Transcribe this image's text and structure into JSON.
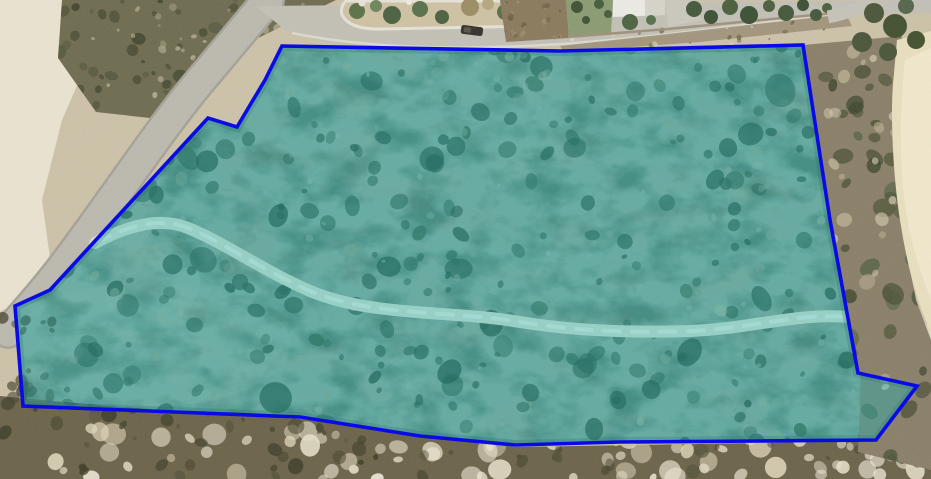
{
  "meta": {
    "view_type": "aerial-satellite-imagery",
    "description": "Satellite photo of coastal scrubland with a surveyed land parcel outlined in blue and washed with a translucent teal highlight; roads and houses border the parcel to the north-west and north."
  },
  "canvas": {
    "width": 931,
    "height": 479,
    "base_color": "#cdc2a8"
  },
  "parcel": {
    "name": "parcel-boundary-overlay",
    "fill": "rgba(0,195,210,0.30)",
    "stroke": "#0a0ae6",
    "stroke_width": 3.6,
    "points": "282,46 560,51 803,45 830,220 858,373 917,386 876,440 760,441 620,442 515,445 420,436 300,417 23,406 15,306 50,290 208,118 237,127 265,80"
  },
  "clips": {
    "parcel": "282,46 560,51 803,45 830,220 858,373 917,386 876,440 760,441 620,442 515,445 420,436 300,417 23,406 15,306 50,290 208,118 237,127 265,80",
    "bottom": "0,396 120,407 300,419 515,447 876,441 931,398 931,479 0,479",
    "right": "803,45 902,36 896,120 902,228 916,300 931,340 931,470 858,452 861,380 828,220",
    "topleft": "62,0 336,0 258,38 205,92 150,118 96,112 58,58"
  },
  "layers": [
    {
      "type": "rect",
      "name": "sand-base",
      "x": 0,
      "y": 0,
      "w": 931,
      "h": 479,
      "fill": "#cdc2a8"
    },
    {
      "type": "polygon",
      "name": "white-sand-west",
      "points": "0,0 72,0 96,42 62,120 42,200 50,258 22,300 0,312",
      "fill": "#ebe5d2",
      "opacity": 0.95
    },
    {
      "type": "ellipse",
      "name": "white-sand-southwest",
      "cx": 60,
      "cy": 448,
      "rx": 130,
      "ry": 38,
      "fill": "#e7e1ce",
      "opacity": 0.9
    },
    {
      "type": "polygon",
      "name": "scrub-northwest",
      "points": "62,0 336,0 258,38 205,92 150,118 96,112 58,58",
      "fill": "#6e6b4f"
    },
    {
      "type": "scatter",
      "name": "scrub-northwest-bushes",
      "clip": "topleft",
      "seed": 11,
      "count": 70,
      "colors": [
        "#45482e",
        "#3c402a",
        "#50543a"
      ],
      "area": [
        58,
        0,
        334,
        120
      ],
      "rmin": 2,
      "rmax": 8,
      "omin": 0.5,
      "omax": 0.85
    },
    {
      "type": "scatter",
      "name": "scrub-northwest-sand-specks",
      "clip": "topleft",
      "seed": 12,
      "count": 40,
      "colors": [
        "#b6b092",
        "#d9d3b8"
      ],
      "area": [
        58,
        0,
        334,
        120
      ],
      "rmin": 1.5,
      "rmax": 5,
      "omin": 0.4,
      "omax": 0.7
    },
    {
      "type": "path",
      "name": "road-west-casing",
      "d": "M 268 0 L 196 86 C 152 140 112 202 62 268 C 42 294 26 312 8 332",
      "stroke": "#a5a296",
      "width": 34,
      "cap": "round"
    },
    {
      "type": "path",
      "name": "road-west",
      "d": "M 268 0 L 196 86 C 152 140 112 202 62 268 C 42 294 26 312 8 332",
      "stroke": "#bcb9af",
      "width": 29,
      "cap": "round"
    },
    {
      "type": "path",
      "name": "road-southwest-edge",
      "d": "M 0 450 L 300 470",
      "stroke": "#8a8779",
      "width": 3
    },
    {
      "type": "path",
      "name": "road-southwest",
      "d": "M 0 462 L 300 478",
      "stroke": "#b2afa6",
      "width": 18
    },
    {
      "type": "polygon",
      "name": "parcel-ground",
      "points": "282,46 560,51 803,45 830,220 858,373 917,386 876,440 760,441 620,442 515,445 420,436 300,417 23,406 15,306 50,290 208,118 237,127 265,80",
      "fill": "#6d7157"
    },
    {
      "type": "ellipse",
      "name": "parcel-light-patch-sw",
      "cx": 150,
      "cy": 345,
      "rx": 140,
      "ry": 62,
      "fill": "#8b8c6d",
      "opacity": 0.5,
      "clip": "parcel"
    },
    {
      "type": "ellipse",
      "name": "parcel-light-patch-w",
      "cx": 108,
      "cy": 282,
      "rx": 92,
      "ry": 55,
      "fill": "#97977a",
      "opacity": 0.4,
      "clip": "parcel"
    },
    {
      "type": "ellipse",
      "name": "parcel-light-patch-n",
      "cx": 430,
      "cy": 120,
      "rx": 185,
      "ry": 70,
      "fill": "#7b7e61",
      "opacity": 0.35,
      "clip": "parcel"
    },
    {
      "type": "rect",
      "name": "vegetation-blotch-dark",
      "x": 0,
      "y": 0,
      "w": 931,
      "h": 479,
      "filter": "blotchDark",
      "clip": "parcel",
      "opacity": 0.5
    },
    {
      "type": "rect",
      "name": "vegetation-blotch-light",
      "x": 0,
      "y": 0,
      "w": 931,
      "h": 479,
      "filter": "blotchLight",
      "clip": "parcel",
      "opacity": 0.45
    },
    {
      "type": "scatter",
      "name": "parcel-shrubs-small",
      "clip": "parcel",
      "seed": 21,
      "count": 240,
      "colors": [
        "#3c4c34",
        "#36462f",
        "#44553a"
      ],
      "area": [
        18,
        46,
        914,
        446
      ],
      "rmin": 3,
      "rmax": 10,
      "omin": 0.45,
      "omax": 0.8
    },
    {
      "type": "scatter",
      "name": "parcel-shrubs-large",
      "clip": "parcel",
      "seed": 22,
      "count": 36,
      "colors": [
        "#33452e",
        "#2f4029"
      ],
      "area": [
        40,
        60,
        900,
        430
      ],
      "rmin": 9,
      "rmax": 16,
      "omin": 0.5,
      "omax": 0.75
    },
    {
      "type": "scatter",
      "name": "parcel-sand-veins",
      "clip": "parcel",
      "seed": 23,
      "count": 170,
      "colors": [
        "#a6a689",
        "#b2b094",
        "#9a9b7e"
      ],
      "area": [
        18,
        46,
        914,
        446
      ],
      "rmin": 2,
      "rmax": 6,
      "omin": 0.35,
      "omax": 0.6
    },
    {
      "type": "path",
      "name": "dirt-track",
      "d": "M 95 243 C 125 227 158 216 188 228 C 225 243 262 270 310 291 C 372 317 450 310 520 322 C 575 331 630 333 690 331 C 735 329 762 322 800 318 C 845 313 888 319 931 332",
      "stroke": "#dcd6c1",
      "width": 12,
      "cap": "round"
    },
    {
      "type": "path",
      "name": "dirt-track-wheelmarks",
      "d": "M 95 243 C 125 227 158 216 188 228 C 225 243 262 270 310 291 C 372 317 450 310 520 322 C 575 331 630 333 690 331 C 735 329 762 322 800 318 C 845 313 888 319 931 332",
      "stroke": "#ece7d7",
      "width": 4,
      "dash": "16 12",
      "cap": "round",
      "opacity": 0.9
    },
    {
      "type": "polygon",
      "name": "scrub-south-band",
      "points": "0,396 120,407 300,419 515,447 876,441 931,398 931,479 0,479",
      "fill": "#6b6349"
    },
    {
      "type": "scatter",
      "name": "south-sand-patches",
      "clip": "bottom",
      "seed": 31,
      "count": 85,
      "colors": [
        "#eae3cd",
        "#dfd6ba",
        "#f2ecd9"
      ],
      "area": [
        0,
        428,
        931,
        479
      ],
      "rmin": 4,
      "rmax": 13,
      "omin": 0.5,
      "omax": 0.9
    },
    {
      "type": "scatter",
      "name": "south-shrubs",
      "clip": "bottom",
      "seed": 32,
      "count": 95,
      "colors": [
        "#45442c",
        "#3a3a25",
        "#55533a"
      ],
      "area": [
        0,
        398,
        931,
        479
      ],
      "rmin": 2,
      "rmax": 8,
      "omin": 0.5,
      "omax": 0.85
    },
    {
      "type": "scatter",
      "name": "west-shrubs",
      "seed": 33,
      "count": 18,
      "colors": [
        "#4f4c33",
        "#44422c"
      ],
      "area": [
        0,
        316,
        52,
        412
      ],
      "rmin": 2.5,
      "rmax": 7,
      "omin": 0.5,
      "omax": 0.8
    },
    {
      "type": "polygon",
      "name": "scrub-east-band",
      "points": "803,45 902,36 896,120 902,228 916,300 931,340 931,470 858,452 861,380 828,220",
      "fill": "#8a7f68"
    },
    {
      "type": "scatter",
      "name": "east-shrubs",
      "clip": "right",
      "seed": 41,
      "count": 60,
      "colors": [
        "#4a5134",
        "#3f472c",
        "#556244"
      ],
      "area": [
        808,
        48,
        931,
        462
      ],
      "rmin": 4,
      "rmax": 11,
      "omin": 0.55,
      "omax": 0.85
    },
    {
      "type": "scatter",
      "name": "east-sand-specks",
      "clip": "right",
      "seed": 42,
      "count": 25,
      "colors": [
        "#d9cfb4",
        "#cabf9f"
      ],
      "area": [
        808,
        48,
        931,
        430
      ],
      "rmin": 3,
      "rmax": 8,
      "omin": 0.4,
      "omax": 0.7
    },
    {
      "type": "path",
      "name": "sand-dune-east",
      "d": "M 897 40 L 931 31 L 931 332 C 917 304 907 264 901 226 C 894 186 890 122 893 84 Z",
      "fill": "#e9dfbf"
    },
    {
      "type": "path",
      "name": "sand-dune-east-highlight",
      "d": "M 905 60 L 931 48 L 931 300 C 919 270 910 240 905 205 C 900 170 899 110 905 60 Z",
      "fill": "#f2ead0",
      "opacity": 0.8
    },
    {
      "type": "polygon",
      "name": "street-north",
      "points": "256,6 931,0 931,13 848,14 680,33 565,45 428,50 330,44 285,30",
      "fill": "#c3c0b6"
    },
    {
      "type": "path",
      "name": "street-north-curb",
      "d": "M 292 33 C 380 51 480 49 562 44 C 660 37 750 24 845 13",
      "stroke": "#dcd9cd",
      "width": 2.5
    },
    {
      "type": "polygon",
      "name": "verge-north",
      "points": "560,46 846,14 852,26 700,42 564,52",
      "fill": "#9b8d74",
      "opacity": 0.85
    },
    {
      "type": "scatter",
      "name": "verge-north-rocks",
      "seed": 51,
      "count": 22,
      "colors": [
        "#e3dcc6",
        "#6b6146"
      ],
      "area": [
        560,
        18,
        848,
        48
      ],
      "rmin": 1,
      "rmax": 3,
      "omin": 0.5,
      "omax": 0.9
    },
    {
      "type": "path",
      "name": "traffic-island",
      "d": "M 346 1 L 556 1 L 556 13 Q 552 25 534 26 L 382 29 Q 350 30 342 15 Q 340 6 346 1 Z",
      "fill": "#cfc2a4",
      "stroke": "#e6e2d6",
      "width": 3
    },
    {
      "type": "circles",
      "name": "traffic-island-trees",
      "item_name": "tree-icon",
      "items": [
        [
          357,
          11,
          8,
          "#5c7147"
        ],
        [
          376,
          6,
          6,
          "#6f845c"
        ],
        [
          392,
          15,
          9,
          "#4b6140"
        ],
        [
          420,
          9,
          8,
          "#57704a"
        ],
        [
          442,
          17,
          7,
          "#4b6140"
        ],
        [
          470,
          7,
          9,
          "#9d8c64"
        ],
        [
          488,
          4,
          6,
          "#b5a87f"
        ],
        [
          505,
          12,
          8,
          "#5a7048"
        ],
        [
          527,
          14,
          7,
          "#62784e"
        ],
        [
          547,
          17,
          5,
          "#55694a"
        ],
        [
          558,
          8,
          5,
          "#6a7f55"
        ],
        [
          362,
          3,
          3.5,
          "#e9e4da"
        ],
        [
          409,
          2,
          3,
          "#efece4"
        ]
      ]
    },
    {
      "type": "polygon",
      "name": "dirt-lot",
      "points": "500,0 566,0 569,38 506,42",
      "fill": "#8a795c"
    },
    {
      "type": "scatter",
      "name": "dirt-lot-texture",
      "seed": 52,
      "count": 25,
      "colors": [
        "#6b5d44",
        "#9c8c6c"
      ],
      "area": [
        505,
        2,
        566,
        40
      ],
      "rmin": 1,
      "rmax": 3.5,
      "omin": 0.5,
      "omax": 0.8
    },
    {
      "type": "polygon",
      "name": "lawn",
      "points": "566,0 613,0 611,34 569,37",
      "fill": "#8a9b72"
    },
    {
      "type": "circles",
      "name": "lawn-trees",
      "item_name": "tree-icon",
      "items": [
        [
          577,
          7,
          6,
          "#3d5233"
        ],
        [
          599,
          4,
          5,
          "#465c38"
        ],
        [
          586,
          20,
          4,
          "#3d5233"
        ],
        [
          608,
          14,
          4,
          "#465c38"
        ]
      ]
    },
    {
      "type": "polygon",
      "name": "house-roof",
      "points": "613,0 665,0 665,15 613,17",
      "fill": "#edebe4"
    },
    {
      "type": "polygon",
      "name": "house-roof-shade",
      "points": "645,0 665,0 665,15 645,16",
      "fill": "#d7d4ca"
    },
    {
      "type": "polygon",
      "name": "driveway",
      "points": "665,0 692,0 702,20 668,27",
      "fill": "#cbc8be"
    },
    {
      "type": "circles",
      "name": "yard-trees",
      "item_name": "tree-icon",
      "items": [
        [
          630,
          22,
          8,
          "#4c6340"
        ],
        [
          651,
          20,
          5,
          "#57704a"
        ]
      ]
    },
    {
      "type": "path",
      "name": "boundary-wall",
      "d": "M 568 37 L 668 29 L 846 12",
      "stroke": "#9f9179",
      "width": 2.5
    },
    {
      "type": "circles",
      "name": "roadside-trees",
      "item_name": "tree-icon",
      "items": [
        [
          694,
          9,
          8,
          "#44583a"
        ],
        [
          711,
          17,
          7,
          "#3b5033"
        ],
        [
          730,
          7,
          8,
          "#4a5f3d"
        ],
        [
          749,
          15,
          9,
          "#3b5033"
        ],
        [
          769,
          6,
          6,
          "#4a5f3d"
        ],
        [
          786,
          13,
          8,
          "#44583a"
        ],
        [
          803,
          5,
          6,
          "#3b5033"
        ],
        [
          816,
          15,
          6,
          "#44583a"
        ],
        [
          827,
          8,
          5,
          "#4a5f3d"
        ]
      ]
    },
    {
      "type": "path",
      "name": "road-northeast",
      "d": "M 828 17 Q 858 11 870 0",
      "stroke": "#c6c3b9",
      "width": 13
    },
    {
      "type": "circles",
      "name": "corner-bushes",
      "item_name": "bush-icon",
      "items": [
        [
          874,
          13,
          10,
          "#4a5538"
        ],
        [
          895,
          26,
          12,
          "#42512f"
        ],
        [
          862,
          42,
          10,
          "#4a5538"
        ],
        [
          906,
          6,
          8,
          "#55654a"
        ],
        [
          916,
          40,
          9,
          "#42512f"
        ],
        [
          888,
          52,
          9,
          "#4a5538"
        ]
      ]
    },
    {
      "type": "rect",
      "name": "parked-car",
      "x": 461,
      "y": 26,
      "w": 22,
      "h": 9,
      "rx": 2.5,
      "fill": "#34322b",
      "transform": "rotate(7 472 30)"
    },
    {
      "type": "rect",
      "name": "parked-car-window",
      "x": 464,
      "y": 28,
      "w": 7,
      "h": 5,
      "rx": 1,
      "fill": "#56544b",
      "transform": "rotate(7 472 30)"
    },
    {
      "type": "rect",
      "name": "photo-grain",
      "x": 0,
      "y": 0,
      "w": 931,
      "h": 479,
      "filter": "grain",
      "opacity": 0.1
    },
    {
      "type": "polygon",
      "name": "parcel-edge-shade",
      "points": "282,46 560,51 803,45 830,220 858,373 917,386 876,440 760,441 620,442 515,445 420,436 300,417 23,406 15,306 50,290 208,118 237,127 265,80",
      "fill": "none",
      "stroke": "#2e4f44",
      "width": 10,
      "opacity": 0.25,
      "clip": "parcel"
    }
  ]
}
